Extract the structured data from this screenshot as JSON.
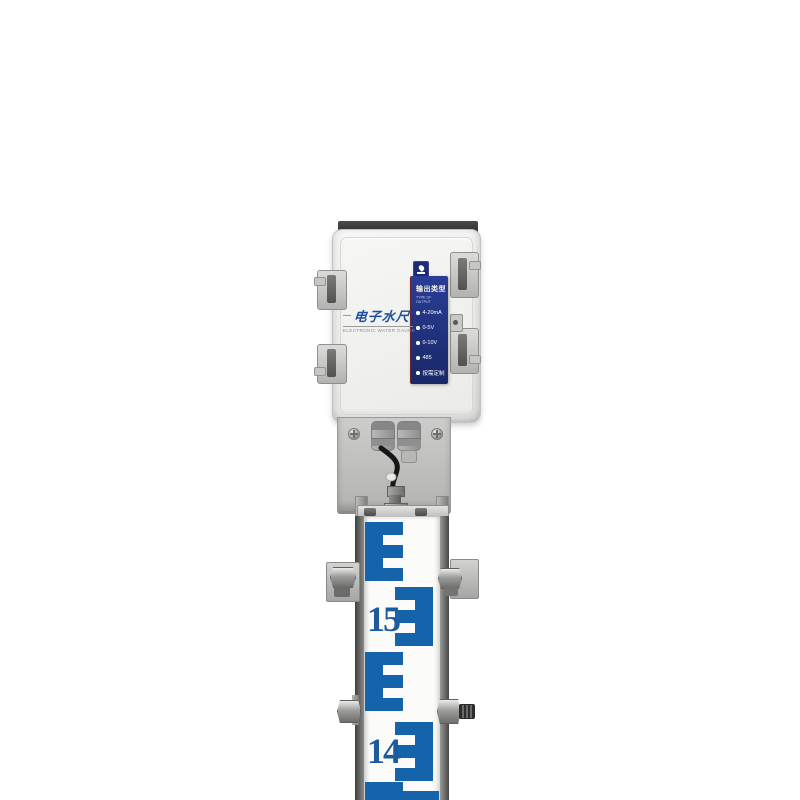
{
  "colors": {
    "gauge_blue": "#1563ab",
    "panel_top": "#2a3d96",
    "panel_bottom": "#192868",
    "label_blue": "#1b4fa0",
    "number_blue": "#1d5a9e"
  },
  "enclosure": {
    "brand_label_cn": "电子水尺",
    "brand_label_en": "ELECTRONIC WATER GAUGE",
    "output_panel": {
      "title": "输出类型",
      "subtitle": "TYPE OF OUTPUT",
      "options": [
        "4-20mA",
        "0-5V",
        "0-10V",
        "485",
        "按需定制"
      ]
    }
  },
  "gauge": {
    "scale_numbers": [
      "15",
      "14"
    ]
  }
}
